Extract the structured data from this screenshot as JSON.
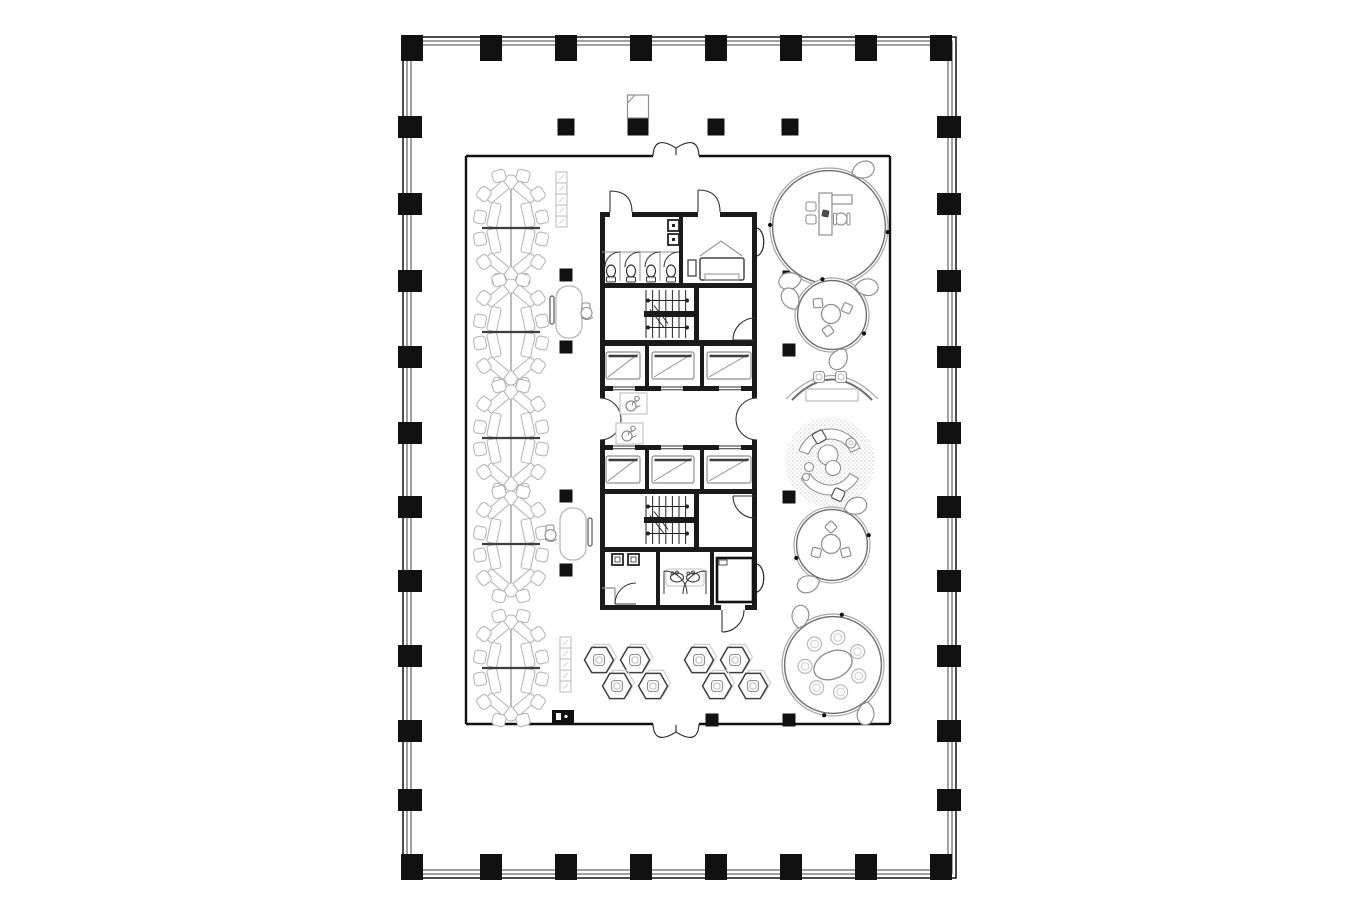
{
  "drawing": {
    "type": "architectural-floor-plan",
    "background": "#ffffff",
    "ink": "#111111",
    "wall_dark": "#1a1a1a",
    "line_mid": "#8f8f8f",
    "line_light": "#b8b8b8",
    "line_dark": "#333333",
    "canvas": {
      "width": 1360,
      "height": 900
    }
  },
  "building": {
    "outer_wall": {
      "x": 403,
      "y": 37,
      "w": 553,
      "h": 841,
      "shell_offsets": [
        0,
        4,
        8
      ]
    },
    "perimeter_columns": {
      "top_xs": [
        412,
        491,
        566,
        641,
        716,
        791,
        866,
        941
      ],
      "bottom_xs": [
        412,
        491,
        566,
        641,
        716,
        791,
        866,
        941
      ],
      "left_ys": [
        127,
        204,
        281,
        357,
        433,
        507,
        581,
        656,
        731,
        800
      ],
      "right_ys": [
        127,
        204,
        281,
        357,
        433,
        507,
        581,
        656,
        731,
        800
      ]
    }
  },
  "office": {
    "boundary": {
      "x": 466,
      "y": 156,
      "w": 424,
      "h": 568
    },
    "doors": [
      {
        "side": "top",
        "cx": 676,
        "width": 46
      },
      {
        "side": "bottom",
        "cx": 676,
        "width": 46
      }
    ],
    "wall_fixture_box": {
      "x": 552,
      "y": 710,
      "w": 22,
      "h": 13
    }
  },
  "interior_columns": {
    "large_size": 17,
    "small_size": 13,
    "large": [
      [
        566,
        127
      ],
      [
        716,
        127
      ],
      [
        790,
        127
      ]
    ],
    "small": [
      [
        566,
        275
      ],
      [
        566,
        347
      ],
      [
        566,
        496
      ],
      [
        566,
        570
      ],
      [
        789,
        277
      ],
      [
        789,
        350
      ],
      [
        789,
        497
      ],
      [
        712,
        720
      ],
      [
        789,
        720
      ]
    ],
    "special": {
      "x": 638,
      "y": 127
    }
  },
  "core": {
    "bounds": {
      "x": 600,
      "y": 212,
      "w": 157,
      "h": 398
    },
    "h_walls_y": [
      212,
      283,
      340,
      386,
      445,
      489,
      547,
      605
    ],
    "restroom": {
      "divider_x": 679,
      "stall_xs": [
        620,
        640,
        660
      ],
      "toilet_cxs": [
        611,
        631,
        651,
        671
      ],
      "top_door_gaps": [
        [
          610,
          632
        ],
        [
          698,
          720
        ]
      ]
    },
    "stairs": {
      "tread_x0": 646,
      "tread_x1": 692,
      "tread_step": 6.6,
      "bands": [
        [
          290,
          311,
          317,
          338
        ],
        [
          496,
          517,
          523,
          544
        ]
      ]
    },
    "elevators": {
      "divider_xs": [
        645,
        700
      ],
      "door_xs": [
        613,
        661,
        719
      ],
      "door_w": 22,
      "cars": [
        [
          606,
          34
        ],
        [
          652,
          42
        ],
        [
          707,
          44
        ]
      ],
      "rows_car_y": [
        352,
        456
      ]
    },
    "lobby": {
      "y0": 391,
      "y1": 445,
      "wc_boxes": [
        [
          620,
          393
        ],
        [
          616,
          423
        ]
      ]
    },
    "bottom": {
      "divider_xs": [
        656,
        710
      ],
      "urinal_xs": [
        612,
        628
      ],
      "sink_cxs": [
        677,
        693
      ],
      "shaft_box": [
        717,
        558,
        36,
        44
      ]
    }
  },
  "furniture": {
    "desk_clusters": {
      "cx": 511,
      "centers_y": [
        228,
        332,
        438,
        544,
        668
      ],
      "chairs_per_cluster": 12
    },
    "locker_strips": [
      {
        "x": 556,
        "y": 172,
        "cells": 5,
        "cell": 11
      },
      {
        "x": 560,
        "y": 637,
        "cells": 5,
        "cell": 11
      }
    ],
    "phone_booths": [
      {
        "x": 556,
        "y": 286,
        "side": 1
      },
      {
        "x": 560,
        "y": 508,
        "side": -1
      }
    ],
    "hex_clusters": {
      "centers": [
        [
          628,
          673
        ],
        [
          728,
          673
        ]
      ],
      "hexes_per_cluster": 4,
      "hex_offsets": [
        [
          -29,
          -13
        ],
        [
          7,
          -13
        ],
        [
          -11,
          13
        ],
        [
          25,
          13
        ]
      ]
    },
    "round_pods": [
      {
        "type": "manager-office-pod",
        "cx": 829,
        "cy": 227,
        "r": 59,
        "flaps": [
          300,
          125
        ],
        "dots": [
          5,
          182
        ]
      },
      {
        "type": "small-meeting-pod",
        "cx": 832,
        "cy": 315,
        "r": 37,
        "flaps": [
          320,
          200,
          80
        ],
        "dots": [
          255,
          30
        ],
        "chair_angles": [
          100,
          220,
          340
        ]
      },
      {
        "type": "crescent-lounge",
        "cx": 832,
        "cy": 383
      },
      {
        "type": "lounge-circle",
        "cx": 830,
        "cy": 462,
        "r": 45
      },
      {
        "type": "small-meeting-pod",
        "cx": 832,
        "cy": 545,
        "r": 38,
        "flaps": [
          300,
          120
        ],
        "dots": [
          345,
          160
        ],
        "chair_angles": [
          30,
          150,
          270
        ]
      },
      {
        "type": "round-meeting-pod",
        "cx": 833,
        "cy": 665,
        "r": 51,
        "flaps": [
          235,
          55
        ],
        "dots": [
          280,
          100
        ],
        "chairs": 7
      }
    ]
  }
}
